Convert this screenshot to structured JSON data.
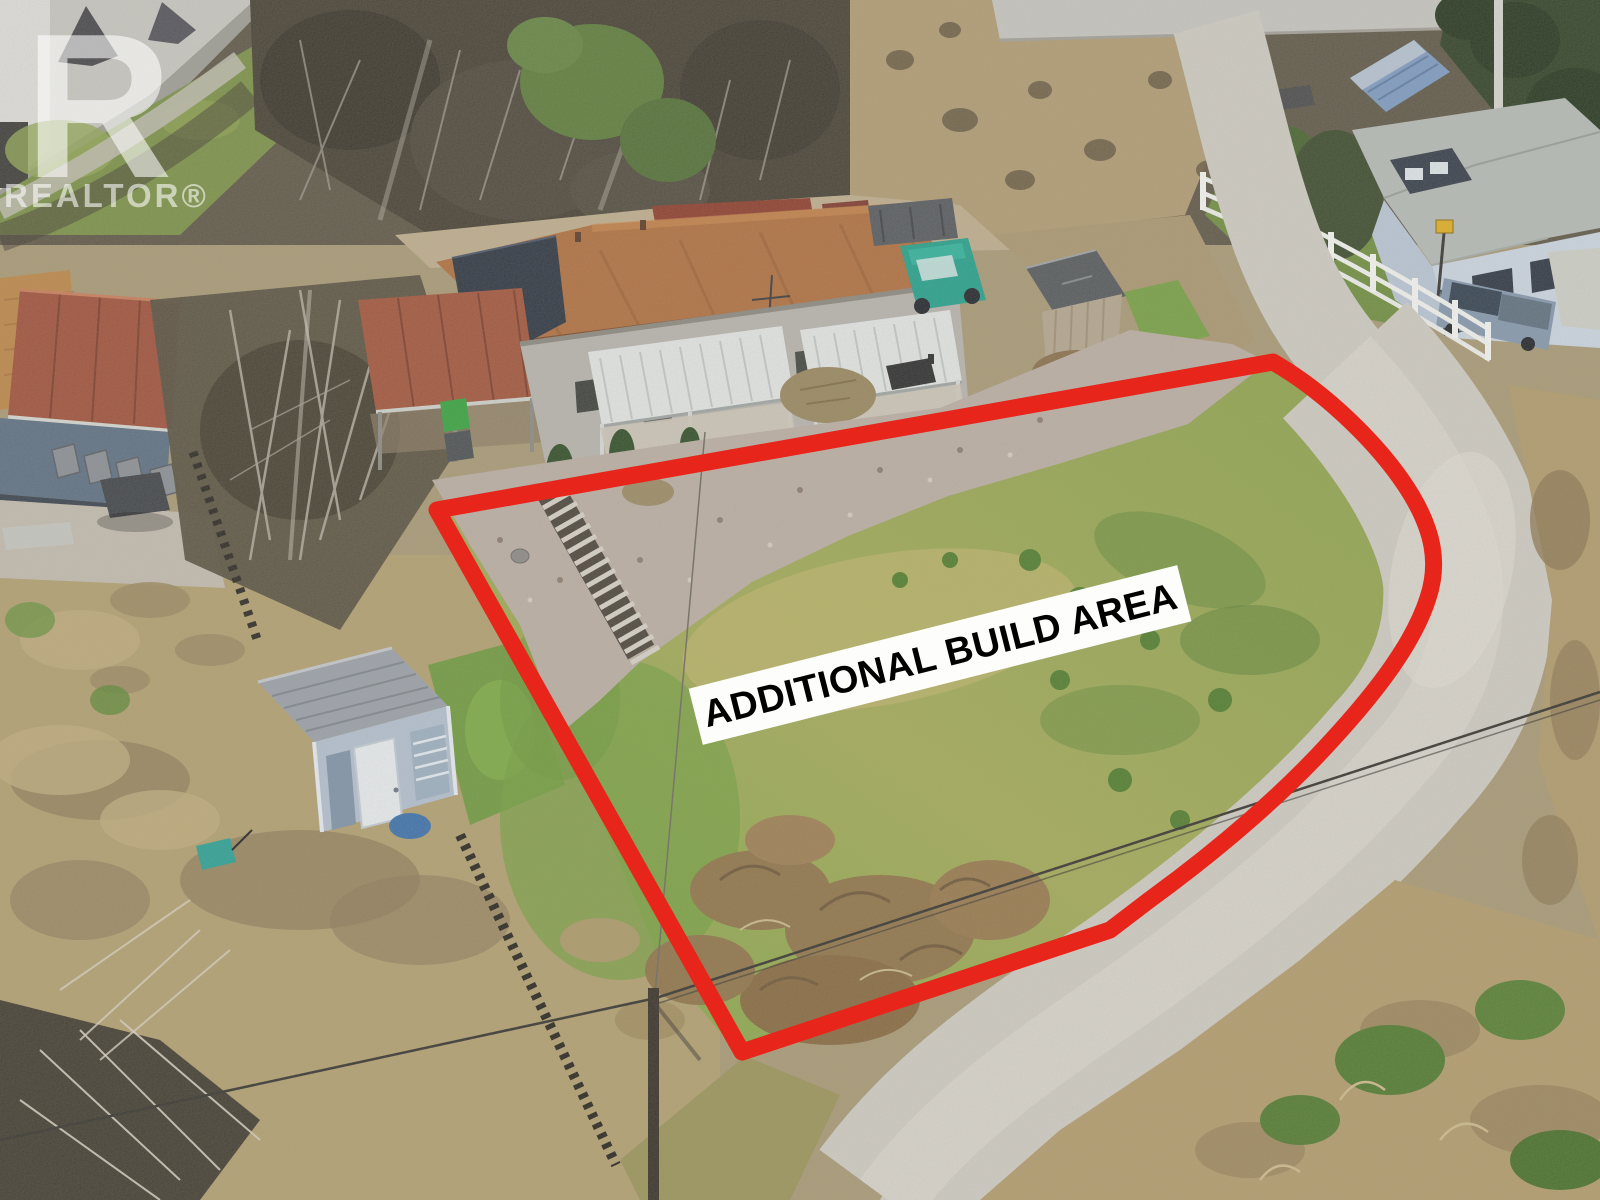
{
  "watermark": {
    "logo_letter": "R",
    "wordmark": "REALTOR®"
  },
  "annotation": {
    "build_area_label": "ADDITIONAL BUILD AREA"
  },
  "colors": {
    "boundary_red": "#e8251a",
    "banner_background": "#fdfdfc",
    "banner_text": "#000000",
    "watermark_white": "rgba(255,255,255,0.58)"
  }
}
